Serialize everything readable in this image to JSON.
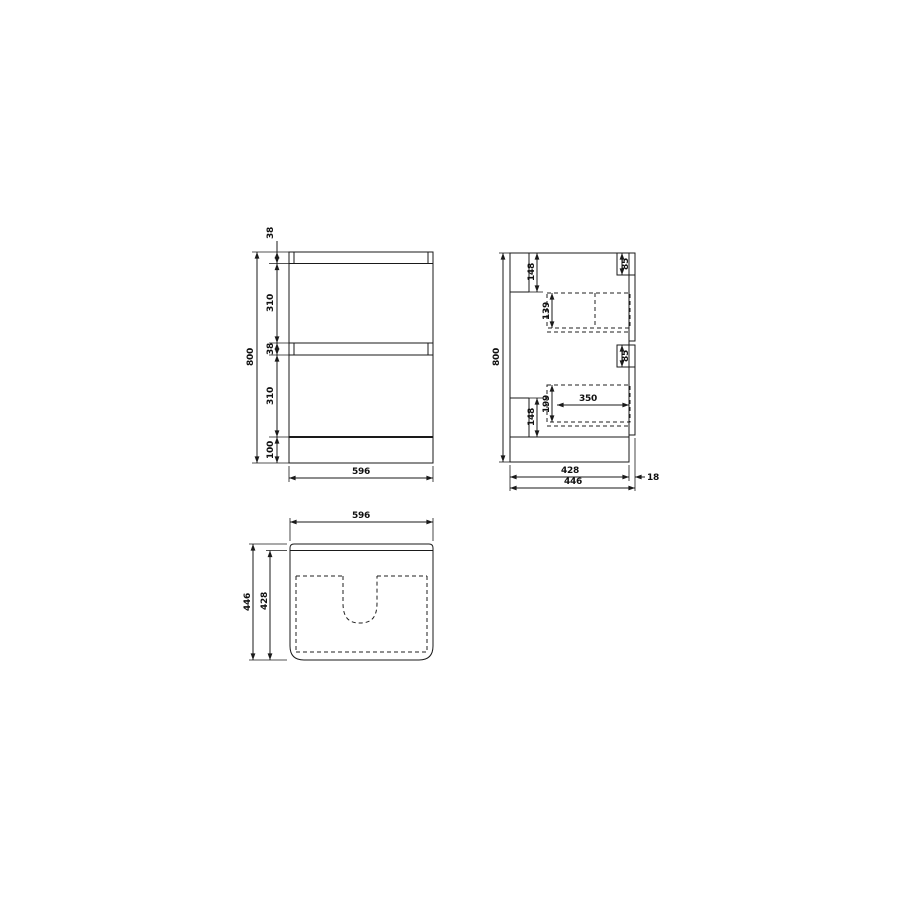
{
  "document": {
    "type": "technical-dimension-drawing",
    "subject": "two-drawer vanity cabinet, three orthographic views",
    "background_color": "#ffffff",
    "line_color": "#1a1a1a"
  },
  "views": {
    "front": {
      "label": "front elevation",
      "dims": {
        "overall_height": "800",
        "top_rail_height": "38",
        "top_drawer_height": "310",
        "mid_rail_height": "38",
        "bottom_drawer_height": "310",
        "plinth_height": "100",
        "overall_width": "596"
      }
    },
    "side": {
      "label": "side elevation",
      "dims": {
        "overall_height": "800",
        "back_rail_top": "148",
        "top_drawer_front_lip": "85",
        "top_drawer_internal_height": "139",
        "bottom_drawer_front_lip": "85",
        "bottom_drawer_internal_height": "199",
        "drawer_internal_depth": "350",
        "back_rail_bottom": "148",
        "carcass_depth": "428",
        "drawer_front_thickness": "18",
        "overall_depth": "446"
      }
    },
    "plan": {
      "label": "plan view",
      "dims": {
        "overall_width": "596",
        "internal_depth": "428",
        "overall_depth": "446"
      }
    }
  }
}
